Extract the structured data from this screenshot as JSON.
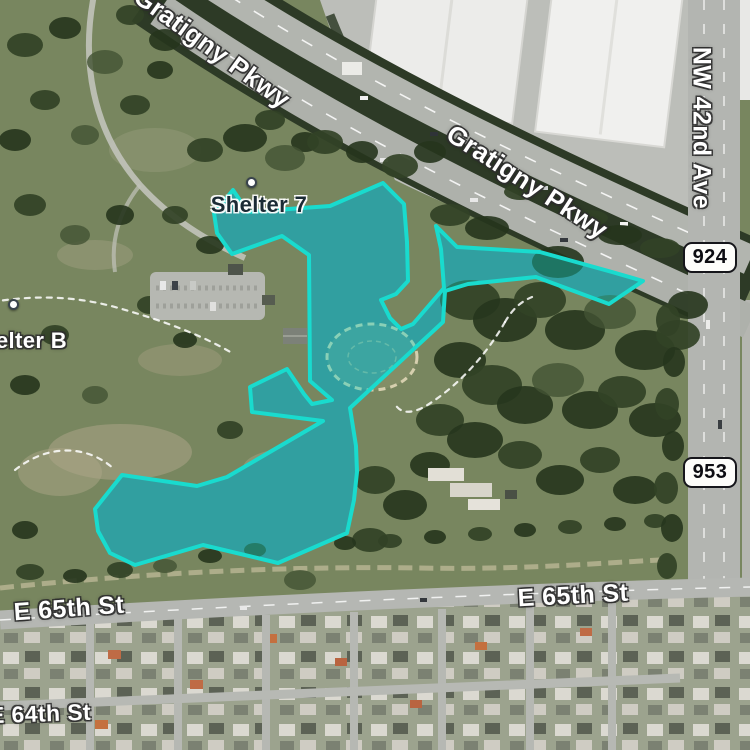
{
  "app": {
    "type": "satellite-map-view"
  },
  "map": {
    "selection": {
      "name": "highlighted-park-lakes-area",
      "fill_color": "#0cd2c6",
      "stroke_color": "#19dbce"
    },
    "road_labels": [
      {
        "id": "gratigny-pkwy-top",
        "text": "Gratigny Pkwy"
      },
      {
        "id": "gratigny-pkwy-main",
        "text": "Gratigny Pkwy"
      },
      {
        "id": "nw-42nd-ave",
        "text": "NW 42nd Ave"
      },
      {
        "id": "e-65th-st-left",
        "text": "E 65th St"
      },
      {
        "id": "e-65th-st-right",
        "text": "E 65th St"
      },
      {
        "id": "e-64th-st",
        "text": "E 64th St"
      }
    ],
    "route_badges": [
      {
        "id": "route-924",
        "text": "924"
      },
      {
        "id": "route-953",
        "text": "953"
      }
    ],
    "poi_labels": [
      {
        "id": "shelter-7",
        "text": "Shelter 7"
      },
      {
        "id": "shelter-b",
        "text": "Shelter B"
      }
    ]
  }
}
